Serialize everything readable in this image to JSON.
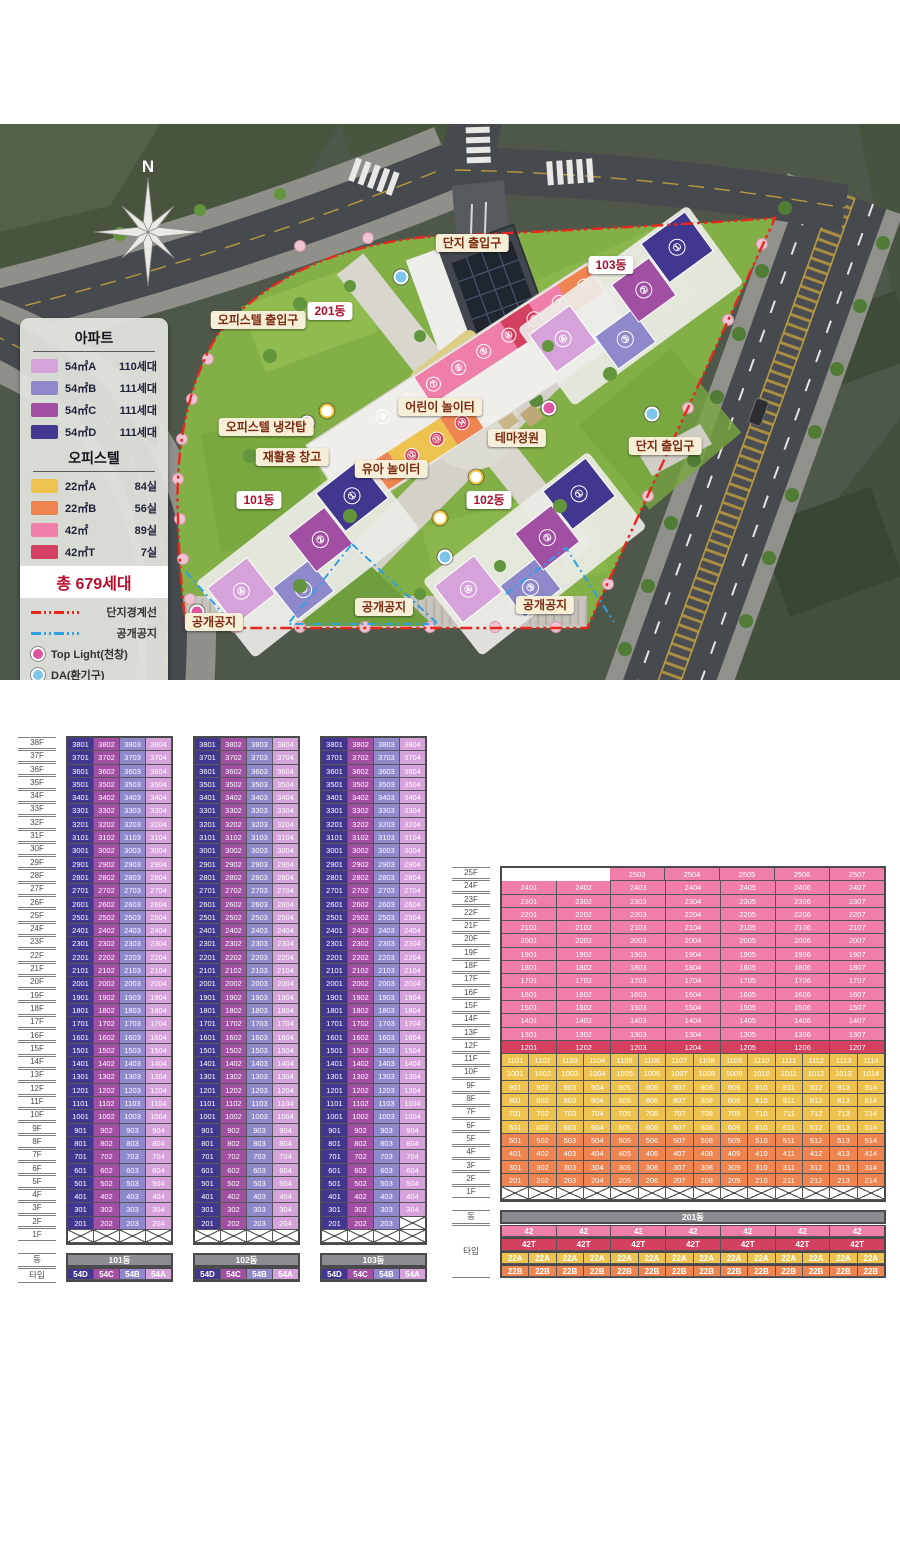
{
  "site_plan": {
    "compass_label": "N",
    "legend": {
      "apartment_title": "아파트",
      "apartment_items": [
        {
          "label": "54㎡A",
          "count": "110세대",
          "color": "#d5a2d9"
        },
        {
          "label": "54㎡B",
          "count": "111세대",
          "color": "#8d89cb"
        },
        {
          "label": "54㎡C",
          "count": "111세대",
          "color": "#a14fa3"
        },
        {
          "label": "54㎡D",
          "count": "111세대",
          "color": "#41378f"
        }
      ],
      "officetel_title": "오피스텔",
      "officetel_items": [
        {
          "label": "22㎡A",
          "count": "84실",
          "color": "#eec24f"
        },
        {
          "label": "22㎡B",
          "count": "56실",
          "color": "#ee8450"
        },
        {
          "label": "42㎡",
          "count": "89실",
          "color": "#ef7fa8"
        },
        {
          "label": "42㎡T",
          "count": "7실",
          "color": "#d4405f"
        }
      ],
      "total_label": "총 679세대",
      "boundary_lines": [
        {
          "label": "단지경계선",
          "color": "#e8281e"
        },
        {
          "label": "공개공지",
          "color": "#2fa0e4"
        }
      ],
      "point_markers": [
        {
          "kind": "toplight",
          "label": "Top Light(천창)",
          "color": "#e0569e"
        },
        {
          "kind": "da",
          "label": "DA(환기구)",
          "color": "#7cc6ec"
        },
        {
          "kind": "trash",
          "label": "쓰레기분리수거함",
          "color": "#f2c230"
        }
      ]
    },
    "labels": [
      {
        "text": "단지 출입구",
        "x": 472,
        "y": 119,
        "style": "plain"
      },
      {
        "text": "오피스텔 출입구",
        "x": 258,
        "y": 196,
        "style": "plain"
      },
      {
        "text": "201동",
        "x": 330,
        "y": 187,
        "style": "building"
      },
      {
        "text": "103동",
        "x": 611,
        "y": 141,
        "style": "building"
      },
      {
        "text": "오피스텔 냉각탑",
        "x": 266,
        "y": 303,
        "style": "plain"
      },
      {
        "text": "재활용 창고",
        "x": 292,
        "y": 333,
        "style": "plain"
      },
      {
        "text": "어린이 놀이터",
        "x": 440,
        "y": 283,
        "style": "plain"
      },
      {
        "text": "테마정원",
        "x": 517,
        "y": 314,
        "style": "plain"
      },
      {
        "text": "유아 놀이터",
        "x": 391,
        "y": 345,
        "style": "plain"
      },
      {
        "text": "101동",
        "x": 259,
        "y": 376,
        "style": "building"
      },
      {
        "text": "102동",
        "x": 489,
        "y": 376,
        "style": "building"
      },
      {
        "text": "단지 출입구",
        "x": 665,
        "y": 322,
        "style": "plain"
      },
      {
        "text": "공개공지",
        "x": 214,
        "y": 498,
        "style": "plain"
      },
      {
        "text": "공개공지",
        "x": 384,
        "y": 483,
        "style": "plain"
      },
      {
        "text": "공개공지",
        "x": 545,
        "y": 481,
        "style": "plain"
      }
    ],
    "map_markers": [
      {
        "kind": "toplight",
        "x": 307,
        "y": 299
      },
      {
        "kind": "toplight",
        "x": 197,
        "y": 488
      },
      {
        "kind": "toplight",
        "x": 549,
        "y": 284
      },
      {
        "kind": "da",
        "x": 401,
        "y": 153
      },
      {
        "kind": "da",
        "x": 652,
        "y": 290
      },
      {
        "kind": "da",
        "x": 445,
        "y": 433
      },
      {
        "kind": "trash",
        "x": 327,
        "y": 287
      },
      {
        "kind": "trash",
        "x": 440,
        "y": 394
      },
      {
        "kind": "trash",
        "x": 476,
        "y": 353
      }
    ],
    "wing_numbers": [
      "①",
      "②",
      "③",
      "④"
    ],
    "officetel_unit_numbers": [
      "①",
      "②",
      "③",
      "④",
      "⑤",
      "⑥",
      "⑦",
      "⑧",
      "⑨",
      "⑩",
      "⑪",
      "⑫",
      "⑬",
      "⑭"
    ]
  },
  "type_colors": {
    "54A": "#d5a2d9",
    "54B": "#8d89cb",
    "54C": "#a14fa3",
    "54D": "#41378f",
    "22A": "#eec24f",
    "22B": "#ee8450",
    "42": "#ef7fa8",
    "42T": "#d4405f"
  },
  "tables": {
    "row_labels": {
      "dong": "동",
      "type": "타입"
    },
    "apartment": {
      "top_floor": 38,
      "bottom_floor": 2,
      "ground_label": "1F",
      "towers": [
        {
          "name": "101동",
          "types": [
            "54D",
            "54C",
            "54B",
            "54A"
          ],
          "missing_2f_cols": []
        },
        {
          "name": "102동",
          "types": [
            "54D",
            "54C",
            "54B",
            "54A"
          ],
          "missing_2f_cols": []
        },
        {
          "name": "103동",
          "types": [
            "54D",
            "54C",
            "54B",
            "54A"
          ],
          "missing_2f_cols": [
            4
          ]
        }
      ]
    },
    "officetel": {
      "name": "201동",
      "top_floor": 25,
      "bottom_floor": 2,
      "ground_label": "1F",
      "ground_cells": 14,
      "bands": [
        {
          "from": 25,
          "to": 25,
          "type": "42",
          "col_from": 3,
          "col_to": 7,
          "span": 2
        },
        {
          "from": 24,
          "to": 13,
          "type": "42",
          "col_from": 1,
          "col_to": 7,
          "span": 2
        },
        {
          "from": 12,
          "to": 12,
          "type": "42T",
          "col_from": 1,
          "col_to": 7,
          "span": 2
        },
        {
          "from": 11,
          "to": 6,
          "type": "22A",
          "col_from": 1,
          "col_to": 14,
          "span": 1
        },
        {
          "from": 5,
          "to": 2,
          "type": "22B",
          "col_from": 1,
          "col_to": 14,
          "span": 1
        }
      ],
      "footer_type_rows": [
        {
          "label": "42",
          "type": "42",
          "count": 7,
          "span": 2
        },
        {
          "label": "42T",
          "type": "42T",
          "count": 7,
          "span": 2
        },
        {
          "label": "22A",
          "type": "22A",
          "count": 14,
          "span": 1
        },
        {
          "label": "22B",
          "type": "22B",
          "count": 14,
          "span": 1
        }
      ]
    }
  }
}
